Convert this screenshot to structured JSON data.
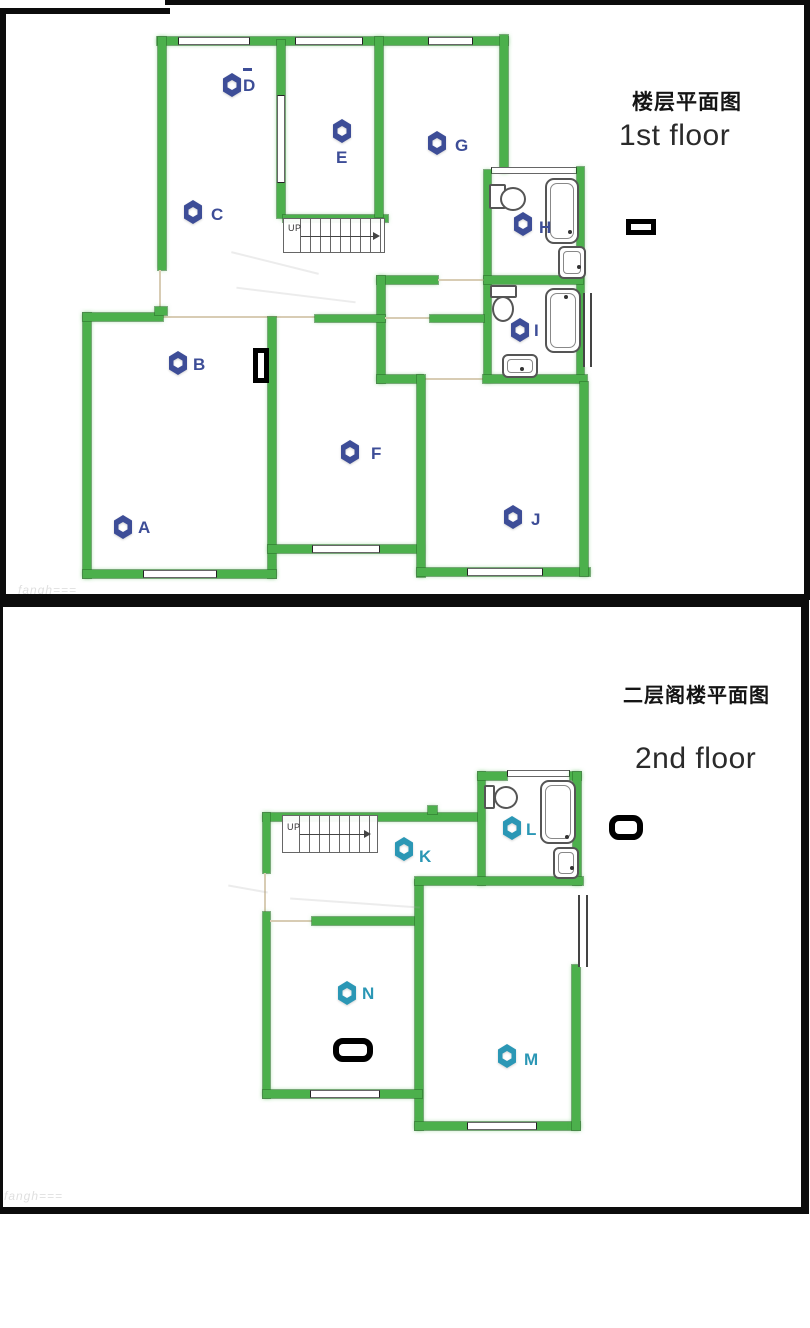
{
  "colors": {
    "wall": "#4cb04c",
    "mk1": "#3d4d97",
    "mk2": "#2b97b5",
    "frame": "#0c0c0c"
  },
  "floor1": {
    "title_zh": "楼层平面图",
    "title_en": "1st floor",
    "stairs_label": "UP",
    "watermark": "fangh===",
    "markers": [
      {
        "id": "A",
        "label": "A"
      },
      {
        "id": "B",
        "label": "B"
      },
      {
        "id": "C",
        "label": "C"
      },
      {
        "id": "D",
        "label": "D"
      },
      {
        "id": "E",
        "label": "E"
      },
      {
        "id": "F",
        "label": "F"
      },
      {
        "id": "G",
        "label": "G"
      },
      {
        "id": "H",
        "label": "H"
      },
      {
        "id": "I",
        "label": "I"
      },
      {
        "id": "J",
        "label": "J"
      }
    ]
  },
  "floor2": {
    "title_zh": "二层阁楼平面图",
    "title_en": "2nd floor",
    "stairs_label": "UP",
    "watermark": "fangh===",
    "markers": [
      {
        "id": "K",
        "label": "K"
      },
      {
        "id": "L",
        "label": "L"
      },
      {
        "id": "M",
        "label": "M"
      },
      {
        "id": "N",
        "label": "N"
      }
    ]
  }
}
